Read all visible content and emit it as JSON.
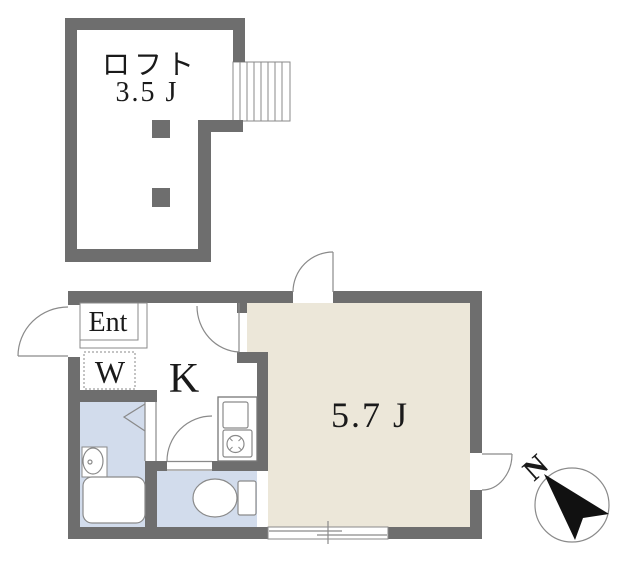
{
  "loft": {
    "name": "ロフト",
    "size": "3.5 J"
  },
  "rooms": {
    "entrance": "Ent",
    "washer": "W",
    "kitchen": "K",
    "main_size": "5.7 J"
  },
  "compass": {
    "north": "N"
  },
  "colors": {
    "wall": "#6e6e6e",
    "wet_area": "#d2dcec",
    "main_floor": "#ece7d9",
    "line": "#8a8a8a",
    "needle": "#111111"
  }
}
